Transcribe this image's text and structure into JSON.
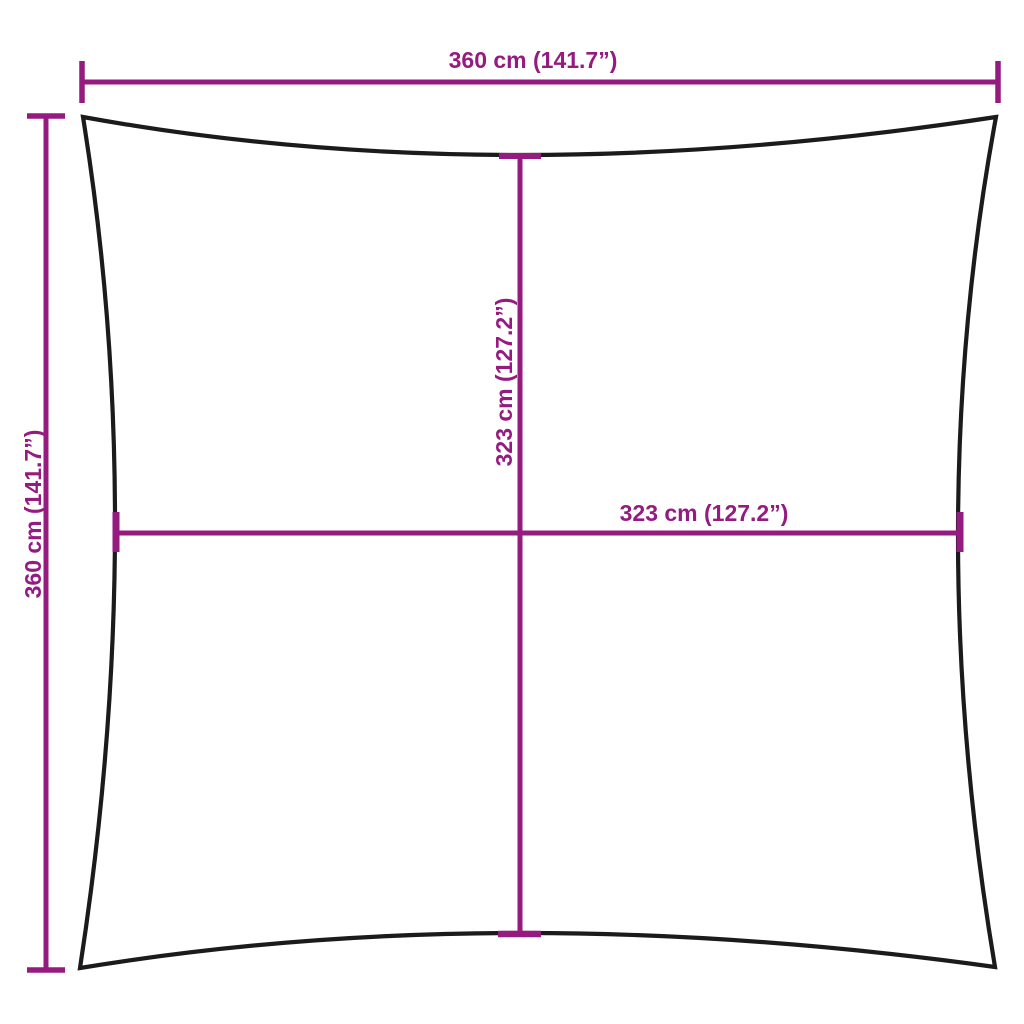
{
  "diagram": {
    "labels": {
      "outer_width": "360 cm (141.7”)",
      "outer_height": "360 cm (141.7”)",
      "inner_height": "323 cm (127.2”)",
      "inner_width": "323 cm (127.2”)"
    },
    "colors": {
      "dimension": "#951b81",
      "outline": "#1b1b1b",
      "background": "#ffffff"
    }
  }
}
